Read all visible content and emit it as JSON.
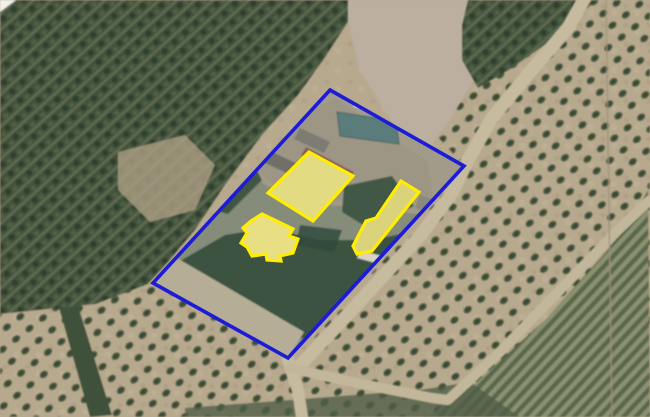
{
  "annotations": {
    "parcel": {
      "points": "330,90 464,166 288,358 153,283",
      "stroke": "#1c1cd8",
      "stroke_width": "3.6"
    },
    "buildings": {
      "stroke": "#ffee00",
      "overlay_fill": "rgba(255,255,60,0.34)",
      "stroke_width": "3.2",
      "items": [
        {
          "id": "building-large-hall",
          "points": "309,152 353,176 313,221 268,193",
          "roof_color": "#d5c9a6"
        },
        {
          "id": "building-house",
          "points": "262,214 293,229 289,236 298,239 293,253 280,256 281,261 267,260 266,254 252,256 247,247 241,243 247,233 243,228 251,221",
          "roof_color": "#dccfab"
        },
        {
          "id": "building-long-barn",
          "points": "401,181 419,192 372,251 357,254 353,246 366,221 376,218",
          "roof_color": "#c7bc9e"
        }
      ]
    }
  }
}
